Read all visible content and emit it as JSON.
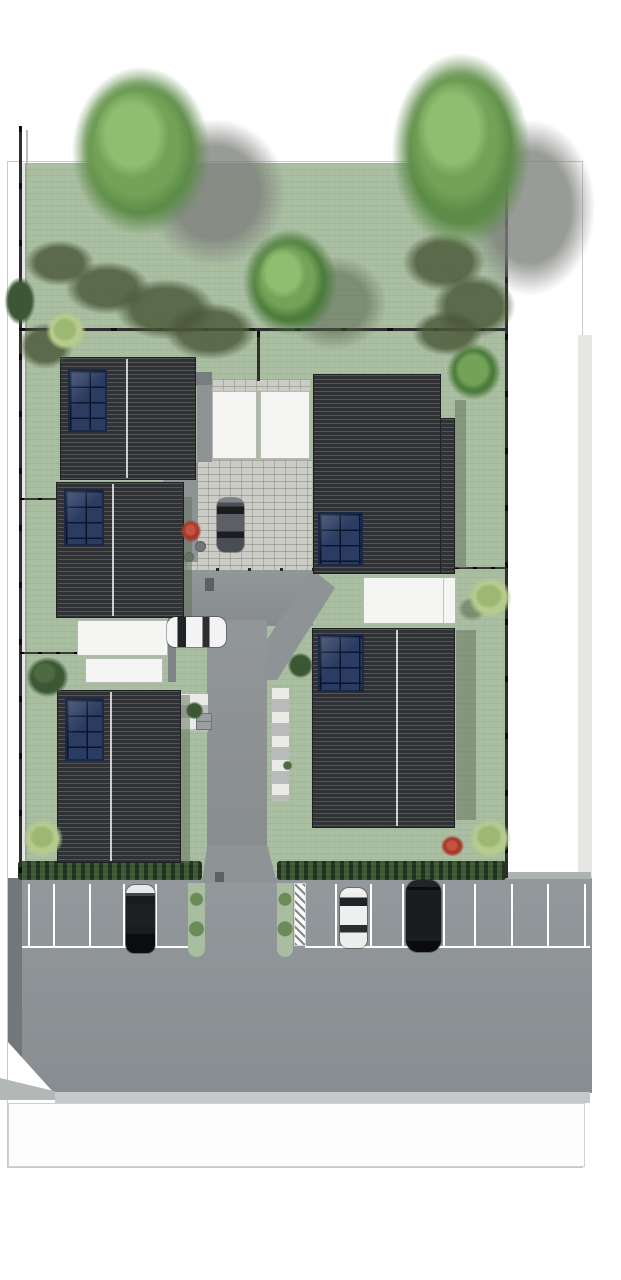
{
  "scene": {
    "type": "architectural-site-plan",
    "view": "top-down render",
    "canvas": {
      "width_px": 621,
      "height_px": 1280
    },
    "description": "Residential site plan: five houses with dark tiled roofs and rooftop solar arrays around a central cobbled courtyard and asphalt driveway, fenced gardens with trees and hedges, street-front parking bays with parked cars, road and sidewalk at the bottom."
  },
  "palette": {
    "page_bg": "#ffffff",
    "outline": "#c9c9c9",
    "lawn": "#a9bda1",
    "hedge": "#2e4729",
    "fence": "#1c1c1c",
    "roof": "#2f3135",
    "ridge": "#dcdcda",
    "solar_panel": "#2b3c62",
    "white_roof": "#f5f5f4",
    "cobblestone": "#ccccc6",
    "asphalt": "#8e9396",
    "asphalt_dark": "#72777a",
    "footpath": "#b9bcba",
    "road": "#8f9598",
    "curb": "#c6c9c9",
    "sidewalk": "#fdfdfd",
    "parking_line": "#ffffff",
    "hatch": "#fafafa",
    "neighbor_strip": "#e7e8e6",
    "apron": "#b4b7b8",
    "road_edge_curb": "#aeb2b3",
    "garden_shade": "rgba(96,112,86,0.5)",
    "tree_green": "#5d8c49",
    "tree_green_dark": "#4d7d3d",
    "bush_light": "#b7cb8f",
    "bush_dark": "#3c5733",
    "bush_red": "#a83a2c",
    "shadow_gray": "#7c7f7b",
    "olive_shadow": "#4a5838",
    "gray_band": "#8f9496",
    "utility_box": "#9aa0a2",
    "drain": "#5b6064",
    "car_white": "#f2f3f2",
    "car_silver": "#eceded",
    "car_black": "#0b0c0d",
    "car_suv_black": "#0a0b0c",
    "car_dark_gray": "#4a4e54"
  },
  "objects": {
    "houses": [
      {
        "id": "house-a",
        "position": "upper-left",
        "roof": "dark tiled, vertical ridge",
        "solar_array": {
          "columns": 2,
          "rows": 4
        }
      },
      {
        "id": "house-b",
        "position": "middle-left",
        "roof": "dark tiled, vertical ridge",
        "solar_array": {
          "columns": 2,
          "rows": 4
        }
      },
      {
        "id": "house-c",
        "position": "lower-left",
        "roof": "dark tiled, vertical ridge",
        "solar_array": {
          "columns": 2,
          "rows": 4
        }
      },
      {
        "id": "house-d",
        "position": "upper-right",
        "roof": "dark tiled, L-shaped",
        "solar_array": {
          "columns": 2,
          "rows": 3
        }
      },
      {
        "id": "house-e",
        "position": "lower-right",
        "roof": "dark tiled, vertical ridge",
        "solar_array": {
          "columns": 2,
          "rows": 3
        }
      }
    ],
    "flat_roofs": [
      {
        "id": "garage-center-1"
      },
      {
        "id": "garage-center-2"
      },
      {
        "id": "garage-left-1"
      },
      {
        "id": "garage-left-2"
      },
      {
        "id": "garage-right"
      }
    ],
    "vehicles": [
      {
        "id": "car-courtyard",
        "color_name": "dark gray",
        "location": "cobblestone courtyard",
        "orientation": "vertical"
      },
      {
        "id": "car-driveway",
        "color_name": "white",
        "location": "asphalt driveway",
        "orientation": "horizontal"
      },
      {
        "id": "car-parking-left",
        "color_name": "black with light hood",
        "location": "left parking bay",
        "orientation": "vertical"
      },
      {
        "id": "car-parking-silver",
        "color_name": "silver",
        "location": "right parking bay",
        "orientation": "vertical"
      },
      {
        "id": "car-parking-suv",
        "color_name": "black SUV",
        "location": "right parking bay",
        "orientation": "vertical"
      }
    ],
    "parking": {
      "left_bay_divider_lines": 5,
      "right_bay_divider_lines": 8,
      "green_planting_strips": 2,
      "hatched_no_parking_strip": 1,
      "stall_end_line_segments": 2
    },
    "vegetation": {
      "large_trees": 2,
      "medium_trees": 2,
      "light_green_bushes": 4,
      "dark_green_bushes": 5,
      "red_flower_bushes": 2,
      "boundary_hedges": 2,
      "conifer_shadow_clusters": 2
    },
    "site": {
      "boundary_outline": true,
      "fences": [
        "left boundary",
        "right boundary",
        "cross fence",
        "center branch",
        "left divider 1",
        "left divider 2",
        "right divider"
      ],
      "roads": [
        "bottom street with parking",
        "central driveway",
        "cobbled courtyard",
        "entry paths"
      ],
      "sidewalk": true
    }
  }
}
